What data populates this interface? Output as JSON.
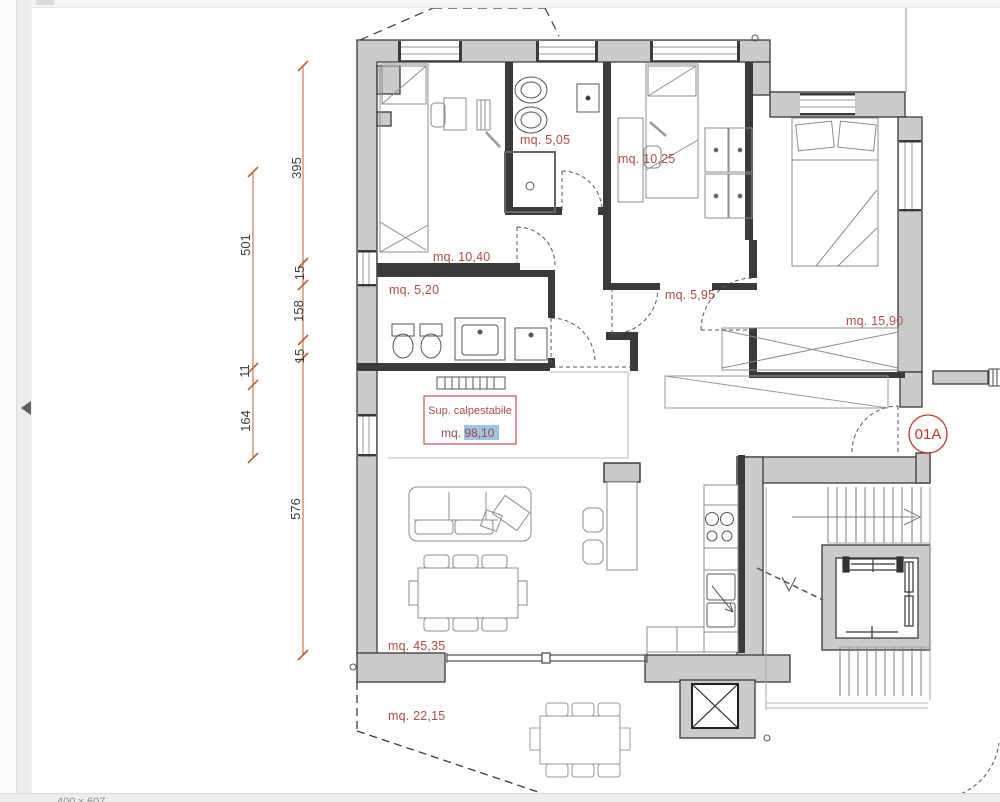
{
  "viewer": {
    "status_text": "400 x 607"
  },
  "plan": {
    "unit_badge": "01A",
    "sup_box": {
      "title": "Sup. calpestabile",
      "prefix": "mq. ",
      "value": "98,10"
    },
    "rooms": [
      {
        "id": "bathroom-1",
        "label": "mq. 5,05"
      },
      {
        "id": "bedroom-2",
        "label": "mq. 10,25"
      },
      {
        "id": "bedroom-1",
        "label": "mq. 10,40"
      },
      {
        "id": "bathroom-2",
        "label": "mq. 5,20"
      },
      {
        "id": "hallway",
        "label": "mq. 5,95"
      },
      {
        "id": "bedroom-3",
        "label": "mq. 15,90"
      },
      {
        "id": "living-room",
        "label": "mq. 45,35"
      },
      {
        "id": "terrace",
        "label": "mq. 22,15"
      }
    ],
    "dimensions": [
      {
        "label": "395"
      },
      {
        "label": "501"
      },
      {
        "label": "15"
      },
      {
        "label": "158"
      },
      {
        "label": "15"
      },
      {
        "label": "11"
      },
      {
        "label": "164"
      },
      {
        "label": "576"
      }
    ],
    "colors": {
      "wall_gray": "#cbcbcb",
      "label_red": "#b54a44",
      "dimension_orange": "#c2602c",
      "selection_blue": "#9fc3e0",
      "badge_red": "#c0392b"
    }
  }
}
